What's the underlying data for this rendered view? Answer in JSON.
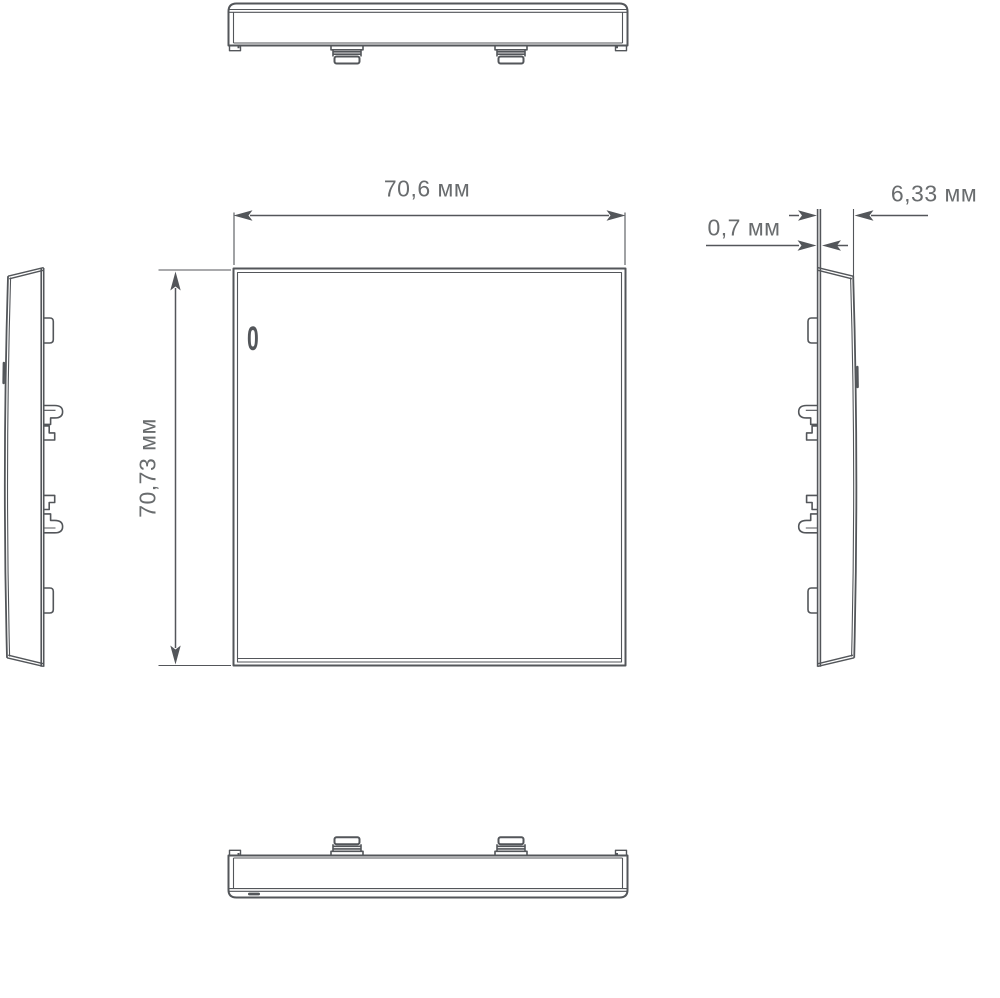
{
  "colors": {
    "line": "#53565a",
    "dim_text": "#696c6e",
    "background": "#ffffff"
  },
  "front_view": {
    "marking": "0"
  },
  "dimensions": {
    "width": "70,6 мм",
    "height": "70,73 мм",
    "front_plate_thickness": "0,7 мм",
    "depth": "6,33 мм"
  }
}
